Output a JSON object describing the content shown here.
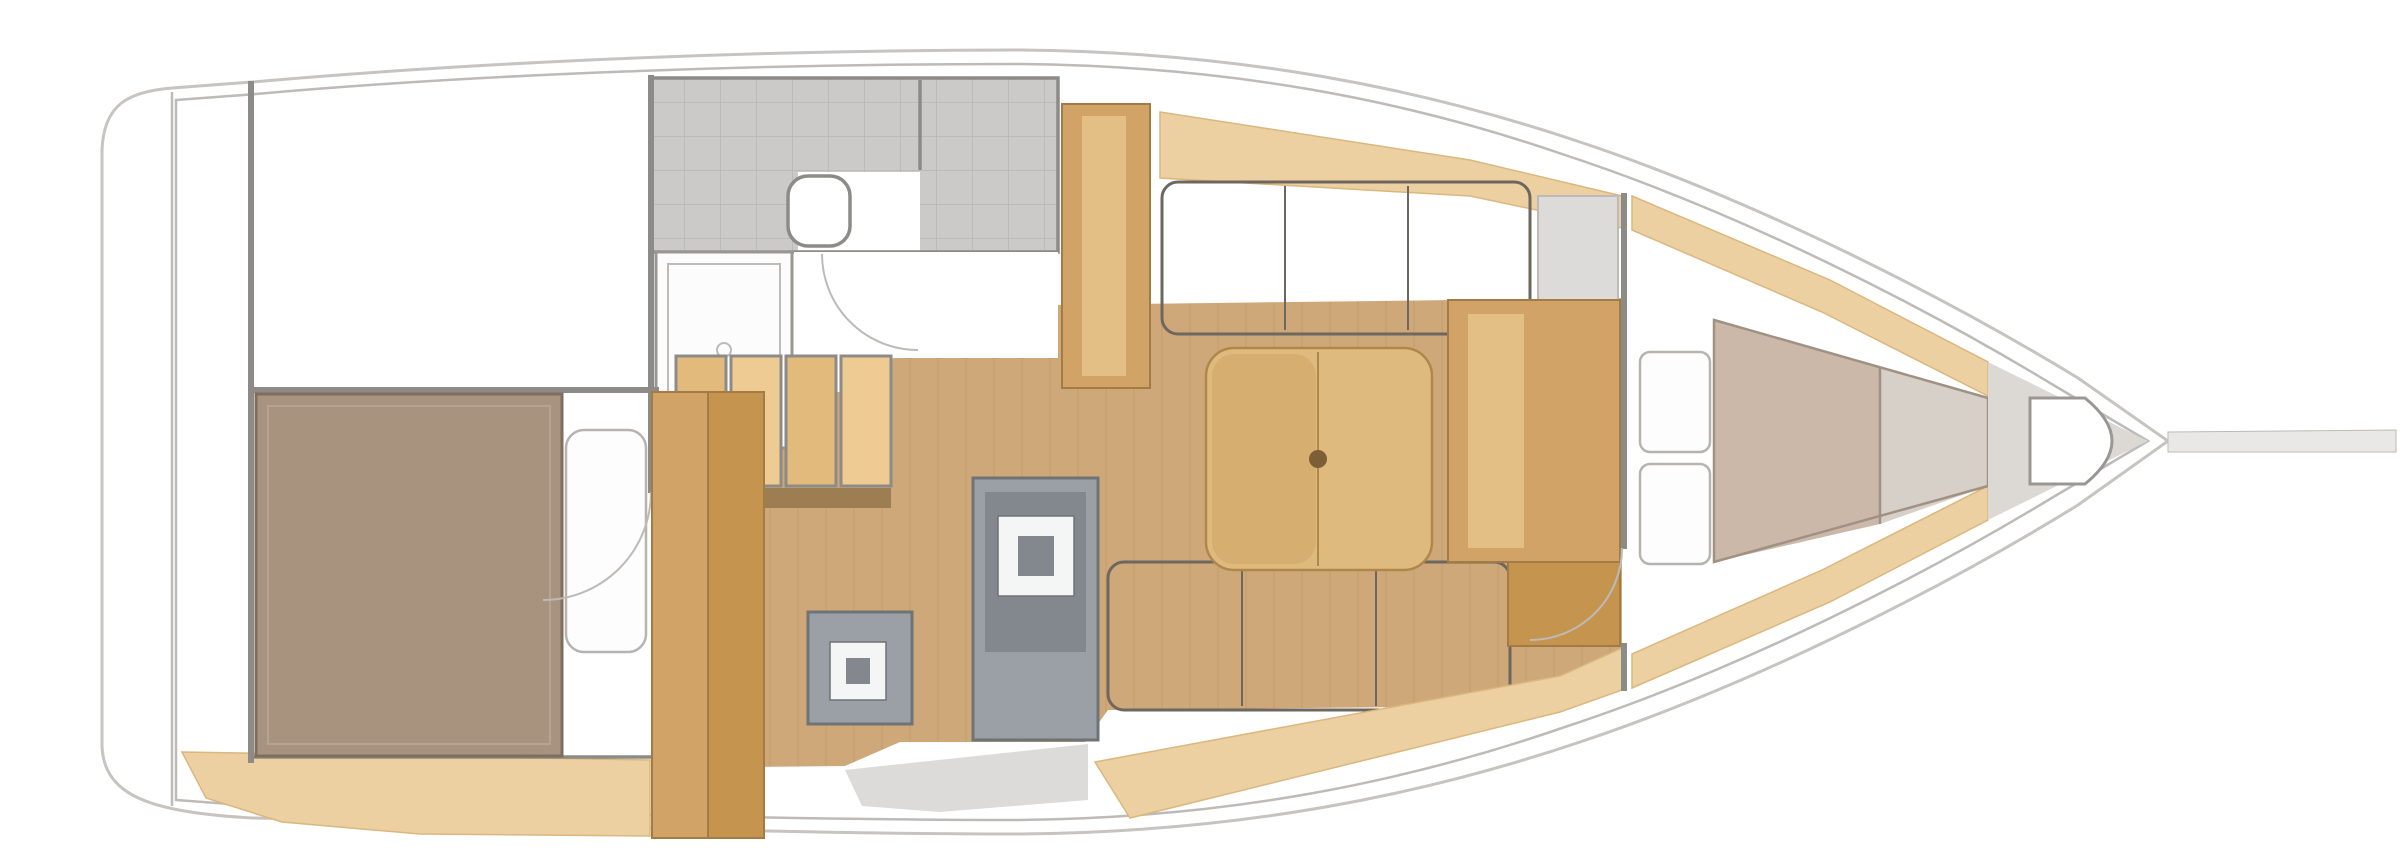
{
  "figure": {
    "kind": "sailboat-interior-floorplan",
    "orientation": "bow-right",
    "rooms": {
      "stern": [
        "transom-locker",
        "aft-cabin",
        "aft-berth",
        "aft-pillow",
        "wardrobe"
      ],
      "midship": [
        "head-compartment",
        "shower-pan",
        "toilet",
        "companionway-steps",
        "galley-stove",
        "galley-sink",
        "cabin-sole"
      ],
      "salon": [
        "port-settee",
        "starboard-settee",
        "folding-table",
        "mast-post",
        "nav-cabinet",
        "forward-locker-seat"
      ],
      "bow": [
        "forward-cabin",
        "v-berth-mattress",
        "v-berth-pillows",
        "anchor-locker",
        "bowsprit"
      ]
    }
  },
  "palette": {
    "bg": "#ffffff",
    "hullLine": "#c6c3c0",
    "linerLine": "#bdbab7",
    "wall": "#8d8b88",
    "tile": "#cbcac8",
    "tileLine": "#b8b6b4",
    "shower": "#fcfcfc",
    "floor": "#cfa87a",
    "plank": "#b9935f",
    "stepLight": "#eecb92",
    "stepMid": "#e2ba7c",
    "stepShadow": "#9d7d52",
    "unitGray": "#9aa0a5",
    "unitDark": "#82888d",
    "unitOutline": "#6e7377",
    "sinkWhite": "#f4f5f5",
    "settee": "#979088",
    "setteeLine": "#837c74",
    "setteeOutline": "#6e675f",
    "table": "#dfba7e",
    "tableEdge": "#b08748",
    "tableLeaf": "#d5ae70",
    "tablePost": "#7d5f35",
    "wood": "#d2a366",
    "woodStripe": "#e4bf85",
    "woodDark": "#c5954f",
    "woodOutline": "#a37c45",
    "sand": "#edd0a1",
    "sandEdge": "#dab77e",
    "bed": "#a8937f",
    "bedEdge": "#7f6e5d",
    "bedInner": "#b7a391",
    "pillow": "#fdfdfd",
    "pillowEdge": "#b7b4b0",
    "mattressA": "#cbb8a8",
    "mattressB": "#d7d0c9",
    "mattressEdge": "#a09183",
    "forepeak": "#dcd8d4",
    "locker": "#ffffff",
    "lockerEdge": "#9a9793",
    "deckShade": "#dcdbd9",
    "bowsprit": "#eae8e6",
    "arc": "#bdbab7"
  }
}
